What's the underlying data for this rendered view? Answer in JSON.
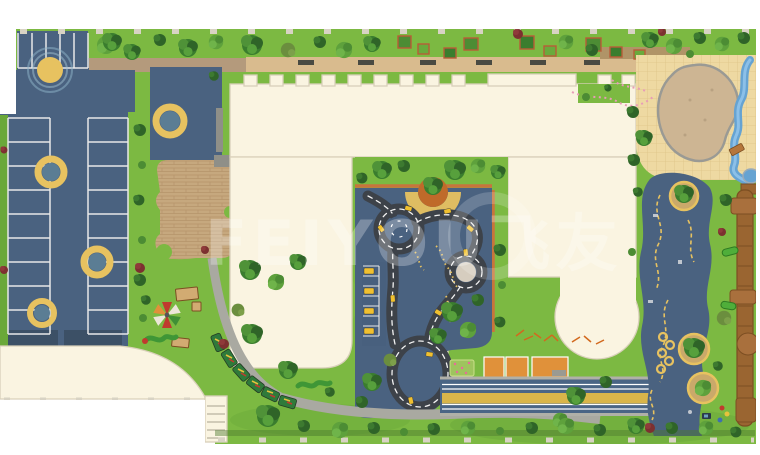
{
  "scene": {
    "type": "playground-master-plan-rendering",
    "watermark_text": "FEIYOU飞友",
    "features": [
      "parking-lot",
      "entry-plaza",
      "paved-plaza",
      "residential-building-complex",
      "traffic-track-playground",
      "mini-roundabout",
      "mini-parking",
      "toddler-playground",
      "windmill-toy",
      "train-toy",
      "caterpillar-toy",
      "sand-play-area",
      "water-stream",
      "adventure-trail",
      "tree-islands",
      "wooden-walkway",
      "running-track",
      "sports-courts",
      "flower-patch",
      "perimeter-fence",
      "planter-boxes",
      "benches"
    ]
  },
  "colors": {
    "outside": "#ffffff",
    "grass": "#7cb942",
    "grass_dark": "#5f9c33",
    "surface": "#4a6280",
    "surface_dark": "#3c5066",
    "teal_inner": "#5b7d94",
    "building": "#faf4e1",
    "building_stroke": "#d9d0ba",
    "plaza_tile": "#eed9a2",
    "tile_line": "#ddc386",
    "sand": "#cdb593",
    "path_sand": "#d9bb8e",
    "path_gray": "#a9a9a1",
    "path_brown": "#b49a7c",
    "brick": "#c6a87e",
    "road": "#3d4249",
    "road_line": "#f2f2f2",
    "yellow": "#e7c260",
    "car_yellow": "#f0c030",
    "terracotta": "#c8743c",
    "orange_court": "#e0913a",
    "wood": "#9a6531",
    "wood_dark": "#7c4e22",
    "water": "#66a3d2",
    "track_blue": "#4a6585",
    "track_yellow": "#d9b54a",
    "fence": "#d8d3c4",
    "wall_gray": "#8f8f88",
    "tree_dark": "#2f6428",
    "tree_mid": "#4c8c34",
    "tree_light": "#6aaa3c",
    "shrub_red": "#7c3030",
    "slide_green": "#4fae3a",
    "pink": "#e89cb8"
  }
}
